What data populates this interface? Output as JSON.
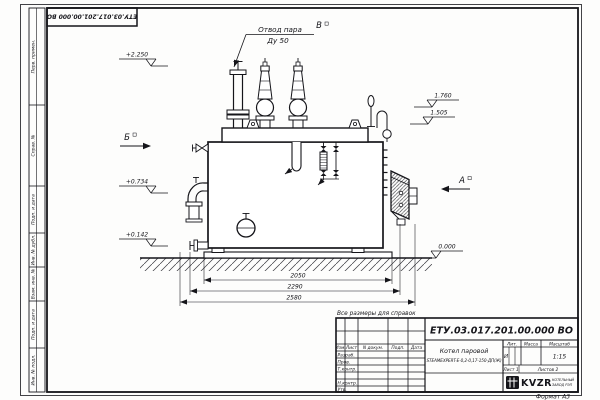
{
  "frame": {
    "top_stamp": "ЕТУ.03.017.201.00.000  ВО",
    "format_note": "Формат  А3",
    "margin_labels": [
      "Перв. примен.",
      "Справ. №",
      "Подп. и дата",
      "Инв. № дубл.",
      "Взам. инв. №",
      "Подп. и дата",
      "Инв. № подл."
    ]
  },
  "drawing": {
    "callout_line1": "Отвод пара",
    "callout_line2": "Ду 50",
    "view_b": "Б",
    "view_v": "В",
    "view_a": "А",
    "elev_2250": "+2.250",
    "elev_1760": "1.760",
    "elev_1505": "1.505",
    "elev_0734": "+0.734",
    "elev_0142": "+0.142",
    "elev_0000": "0.000",
    "dim_inner": "2050",
    "dim_mid": "2290",
    "dim_outer": "2580",
    "ref_note": "Все размеры для справок"
  },
  "title_block": {
    "doc_number": "ЕТУ.03.017.201.00.000  ВО",
    "product_name": "Котел паровой",
    "product_model": "STEAMEXPERT-Е-0,2-0,17-150-ДП(Ж)",
    "col_izm": "Изм.",
    "col_list": "Лист",
    "col_ndoc": "N докум.",
    "col_podp": "Подп.",
    "col_data": "Дата",
    "row_razrab": "Разраб.",
    "row_prov": "Пров.",
    "row_tkontr": "Т.контр.",
    "row_nkontr": "Н.контр.",
    "row_utv": "Утв.",
    "hdr_lit": "Лит.",
    "hdr_mass": "Масса",
    "hdr_scale": "Масштаб",
    "litera": "И",
    "scale": "1:15",
    "sheet": "Лист 1",
    "sheets": "Листов 2",
    "logo_text": "KVZR",
    "logo_caption1": "КОТЕЛЬНЫЙ",
    "logo_caption2": "ЗАВОД РЭП"
  }
}
